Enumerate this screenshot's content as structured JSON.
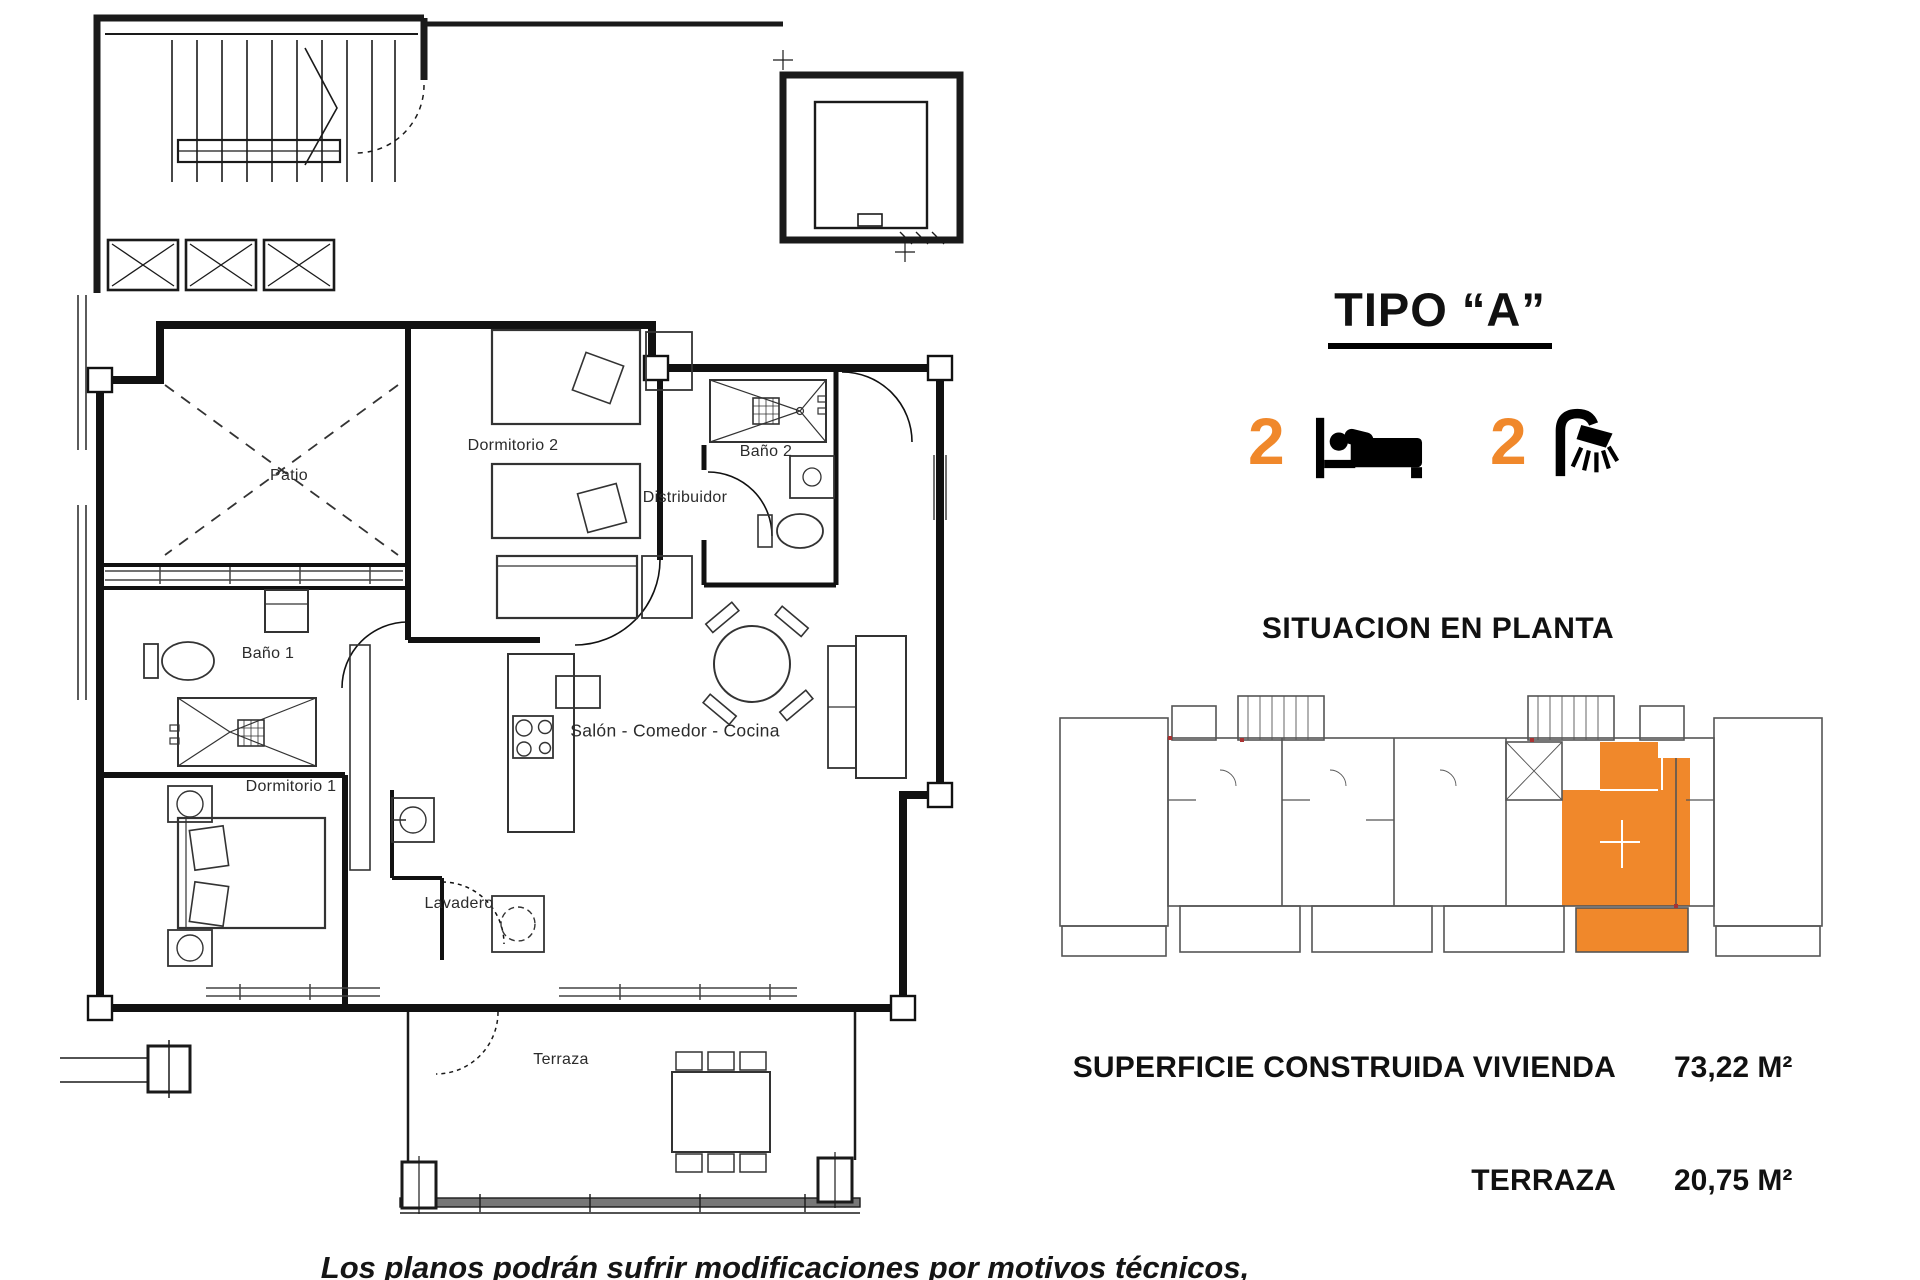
{
  "page": {
    "unit_title": "TIPO “A”",
    "bedrooms": "2",
    "bathrooms": "2",
    "situacion_heading": "SITUACION EN PLANTA",
    "areas": [
      {
        "label": "SUPERFICIE CONSTRUIDA VIVIENDA",
        "value": "73,22 M²"
      },
      {
        "label": "TERRAZA",
        "value": "20,75 M²"
      }
    ],
    "disclaimer": "Los planos podrán sufrir modificaciones por motivos técnicos, jurídicos y comerciales"
  },
  "rooms": {
    "patio": "Patio",
    "dormitorio2": "Dormitorio 2",
    "bano2": "Baño 2",
    "distribuidor": "Distribuidor",
    "bano1": "Baño 1",
    "salon": "Salón - Comedor - Cocina",
    "dormitorio1": "Dormitorio 1",
    "lavadero": "Lavadero",
    "terraza": "Terraza"
  },
  "colors": {
    "accent": "#F0882B",
    "line": "#1a1a1a",
    "keyplan": "#555555"
  },
  "icons": {
    "bedrooms": "bed-icon",
    "bathrooms": "shower-icon"
  }
}
